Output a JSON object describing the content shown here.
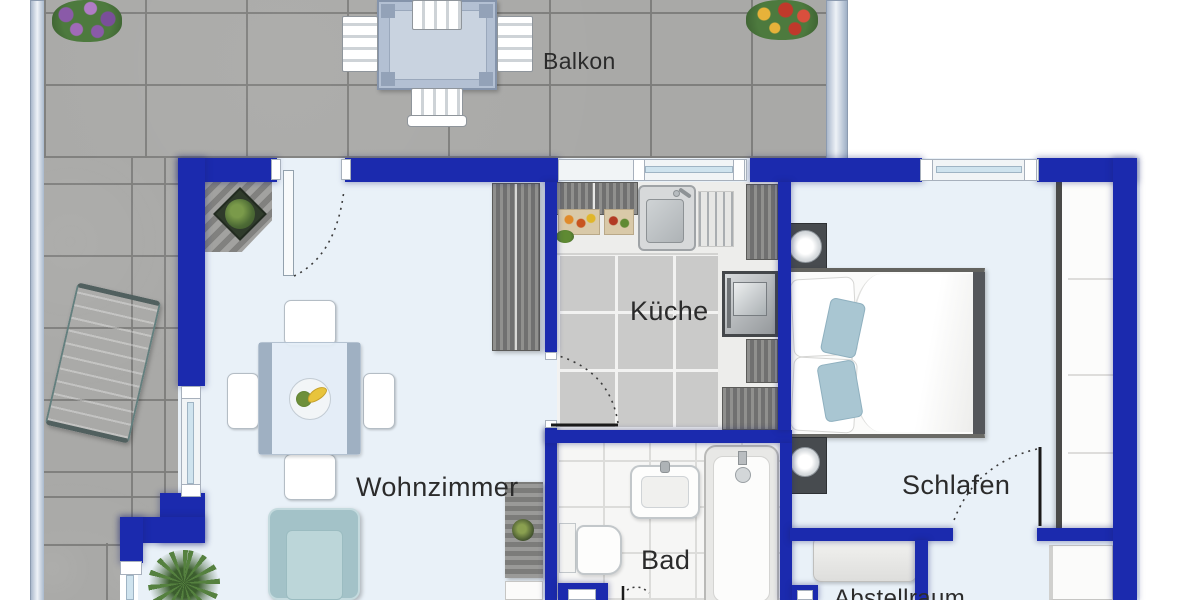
{
  "plan": {
    "type": "apartment-floor-plan",
    "rooms": {
      "balkon": {
        "label": "Balkon"
      },
      "wohnzimmer": {
        "label": "Wohnzimmer"
      },
      "kueche": {
        "label": "Küche"
      },
      "bad": {
        "label": "Bad"
      },
      "schlafen": {
        "label": "Schlafen"
      },
      "abstellraum": {
        "label": "Abstellraum"
      }
    },
    "colors": {
      "wall": "#1b2aae",
      "interior_floor": "#e9f1f8",
      "balcony_tile": "#a9a9a7",
      "kitchen_tile": "#cacac9",
      "bath_tile": "#f6f6f5",
      "furniture_accent_teal": "#aecdd1",
      "label_text": "#2b2b2b"
    },
    "furniture": [
      "balcony-dining-set",
      "sun-lounger",
      "flower-box-purple",
      "flower-box-red",
      "corner-shelf-plant",
      "tall-cabinet",
      "dining-table",
      "dining-chairs",
      "fruit-bowl",
      "sideboard",
      "armchair",
      "yucca-plant",
      "kitchen-counter",
      "kitchen-sink",
      "oven",
      "washbasin",
      "toilet",
      "bathtub",
      "double-bed",
      "nightstands",
      "wardrobe",
      "dresser",
      "hall-cabinet"
    ]
  }
}
